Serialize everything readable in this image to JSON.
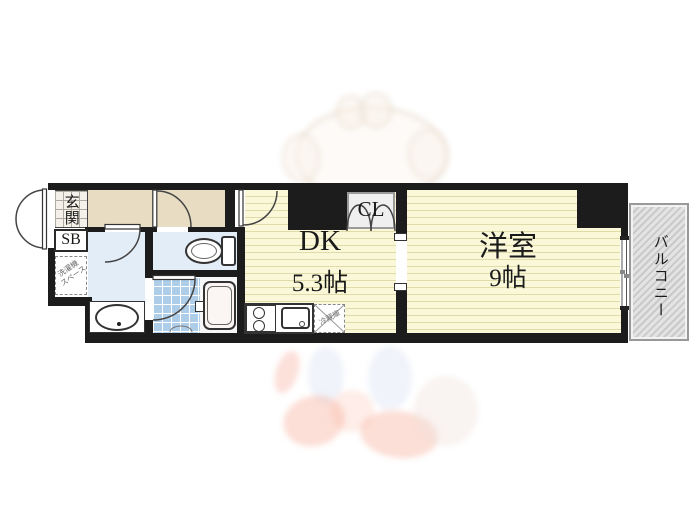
{
  "floorplan": {
    "entrance": {
      "label": "玄関"
    },
    "shoe_box": {
      "label": "SB"
    },
    "washing_machine_space": {
      "line1": "洗濯機",
      "line2": "スペース"
    },
    "dining_kitchen": {
      "label": "DK",
      "size": "5.3帖"
    },
    "closet": {
      "label": "CL"
    },
    "western_room": {
      "label": "洋室",
      "size": "9帖"
    },
    "balcony": {
      "label": "バルコニー"
    },
    "refrigerator_space": {
      "label": "冷蔵庫"
    }
  },
  "colors": {
    "wall": "#1c1c1c",
    "hallway_floor": "#e8dcc2",
    "room_floor": "#faf8d8",
    "room_floor_stripe": "#e0dca9",
    "wet_area_floor": "#e3edf7",
    "bath_tile": "#aecde9",
    "balcony_hatch": "#c9c9c9",
    "text": "#1a1a1a"
  }
}
